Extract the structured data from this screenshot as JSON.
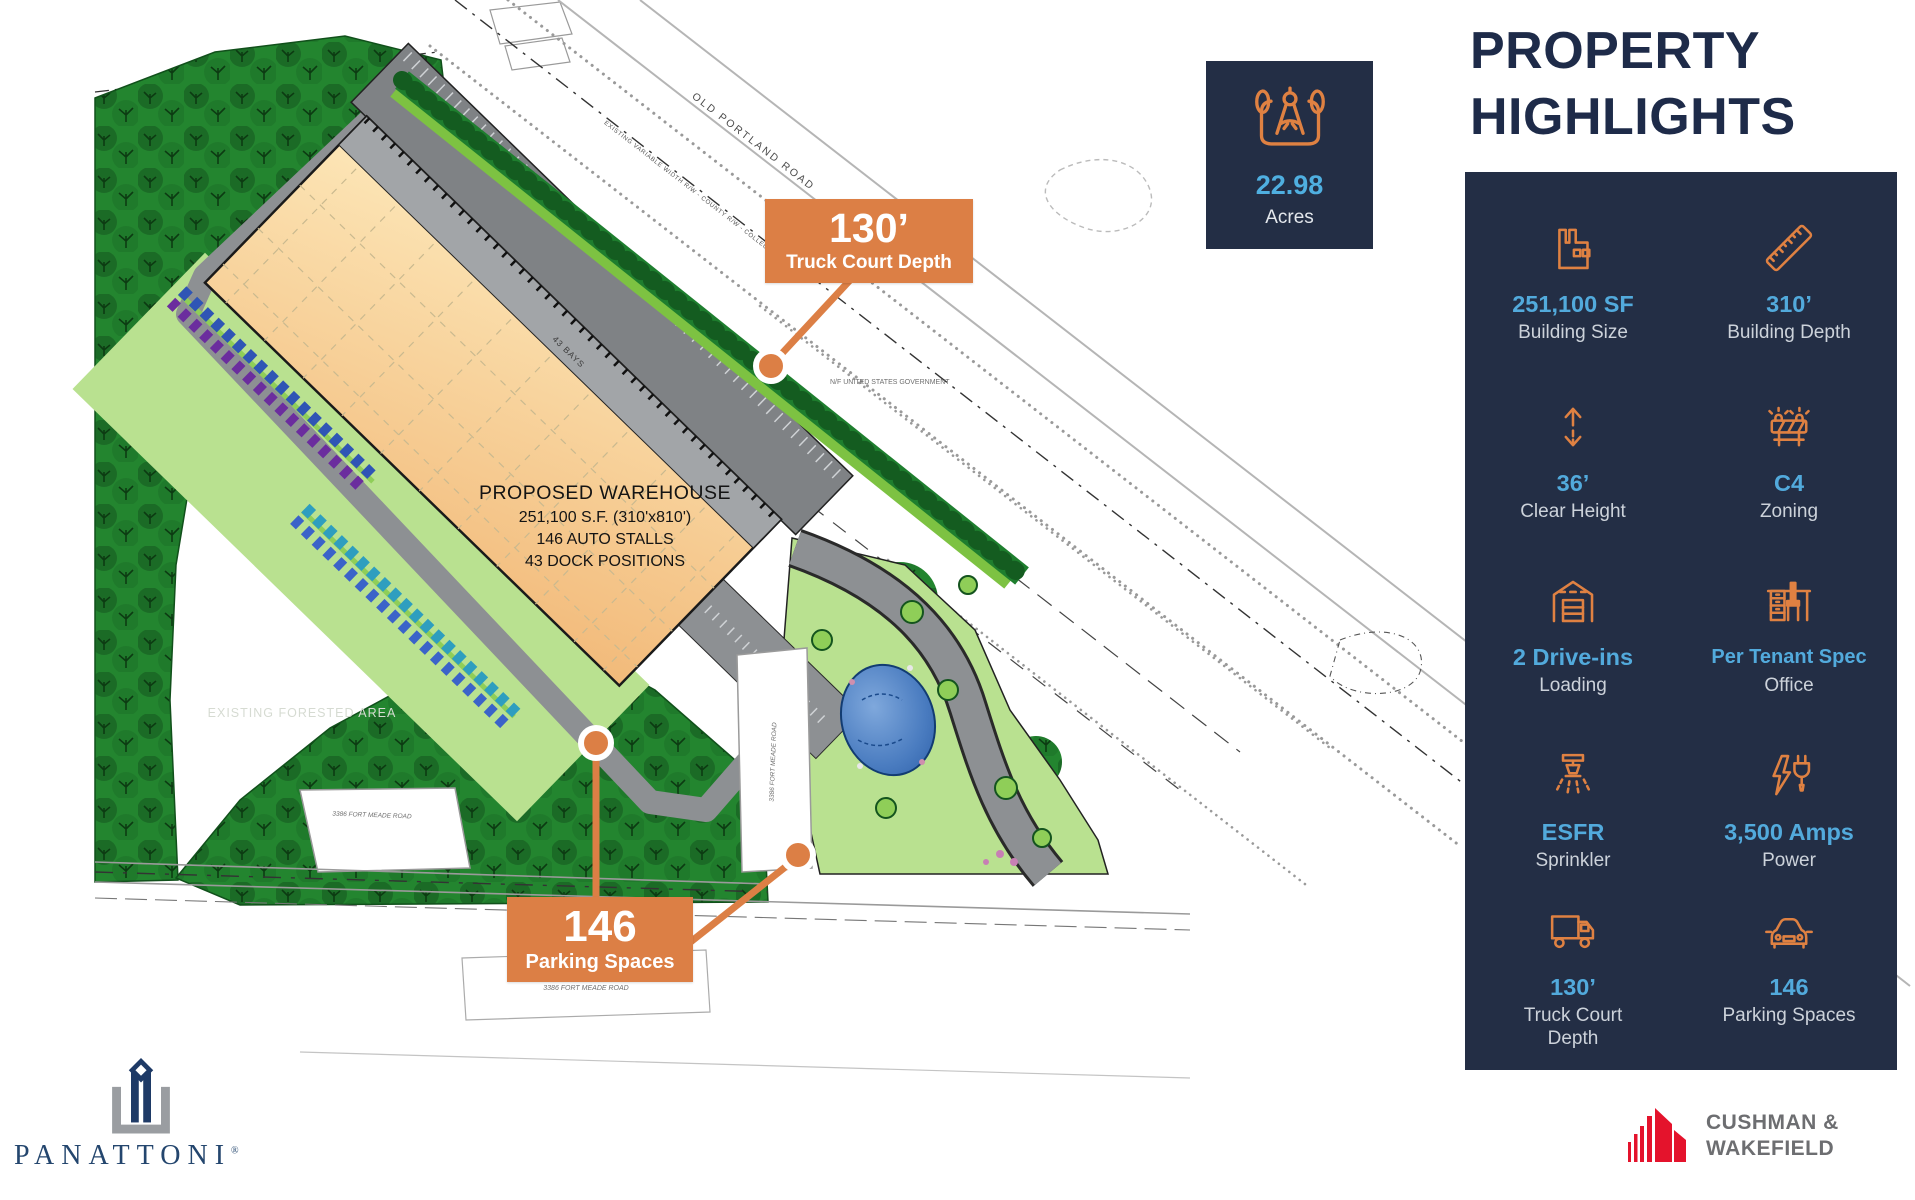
{
  "map": {
    "road_label": "OLD PORTLAND ROAD",
    "road_sublabel": "EXISTING VARIABLE WIDTH R/W - COUNTY R/W - COLLECTOR ROAD",
    "parcel_label": "N/F UNITED STATES GOVERNMENT",
    "forest_label": "EXISTING FORESTED AREA",
    "bays_label": "43 BAYS",
    "address_label_1": "3386 FORT MEADE ROAD",
    "address_label_2": "3386 FORT MEADE ROAD",
    "address_label_3": "3386 FORT MEADE ROAD",
    "building": {
      "line1": "PROPOSED WAREHOUSE",
      "line2": "251,100 S.F. (310'x810')",
      "line3": "146 AUTO STALLS",
      "line4": "43 DOCK POSITIONS"
    },
    "callouts": {
      "truck": {
        "value": "130’",
        "label": "Truck Court Depth"
      },
      "parking": {
        "value": "146",
        "label": "Parking Spaces"
      }
    }
  },
  "acres_card": {
    "value": "22.98",
    "label": "Acres",
    "icon": "drafting-compass-icon"
  },
  "highlights": {
    "title_line1": "PROPERTY",
    "title_line2": "HIGHLIGHTS",
    "items": [
      {
        "icon": "factory-icon",
        "value": "251,100 SF",
        "label": "Building Size"
      },
      {
        "icon": "ruler-icon",
        "value": "310’",
        "label": "Building Depth"
      },
      {
        "icon": "height-arrows-icon",
        "value": "36’",
        "label": "Clear Height"
      },
      {
        "icon": "barricade-icon",
        "value": "C4",
        "label": "Zoning"
      },
      {
        "icon": "garage-icon",
        "value": "2 Drive-ins",
        "label": "Loading"
      },
      {
        "icon": "desk-icon",
        "value": "Per Tenant Spec",
        "label": "Office"
      },
      {
        "icon": "sprinkler-icon",
        "value": "ESFR",
        "label": "Sprinkler"
      },
      {
        "icon": "power-plug-icon",
        "value": "3,500 Amps",
        "label": "Power"
      },
      {
        "icon": "truck-icon",
        "value": "130’",
        "label": "Truck Court Depth"
      },
      {
        "icon": "car-icon",
        "value": "146",
        "label": "Parking Spaces"
      }
    ]
  },
  "branding": {
    "panattoni_name": "PANATTONI",
    "panattoni_reg": "®",
    "cushman_line1": "CUSHMAN &",
    "cushman_line2": "WAKEFIELD"
  },
  "colors": {
    "accent_orange": "#DC7F45",
    "panel_navy": "#232E45",
    "value_blue": "#52AADC",
    "title_navy": "#1E2B49",
    "cushman_red": "#E4132C",
    "forest_green": "#1E7E2E",
    "lawn_green": "#B9E190",
    "building_tan": "#F8D79A"
  }
}
